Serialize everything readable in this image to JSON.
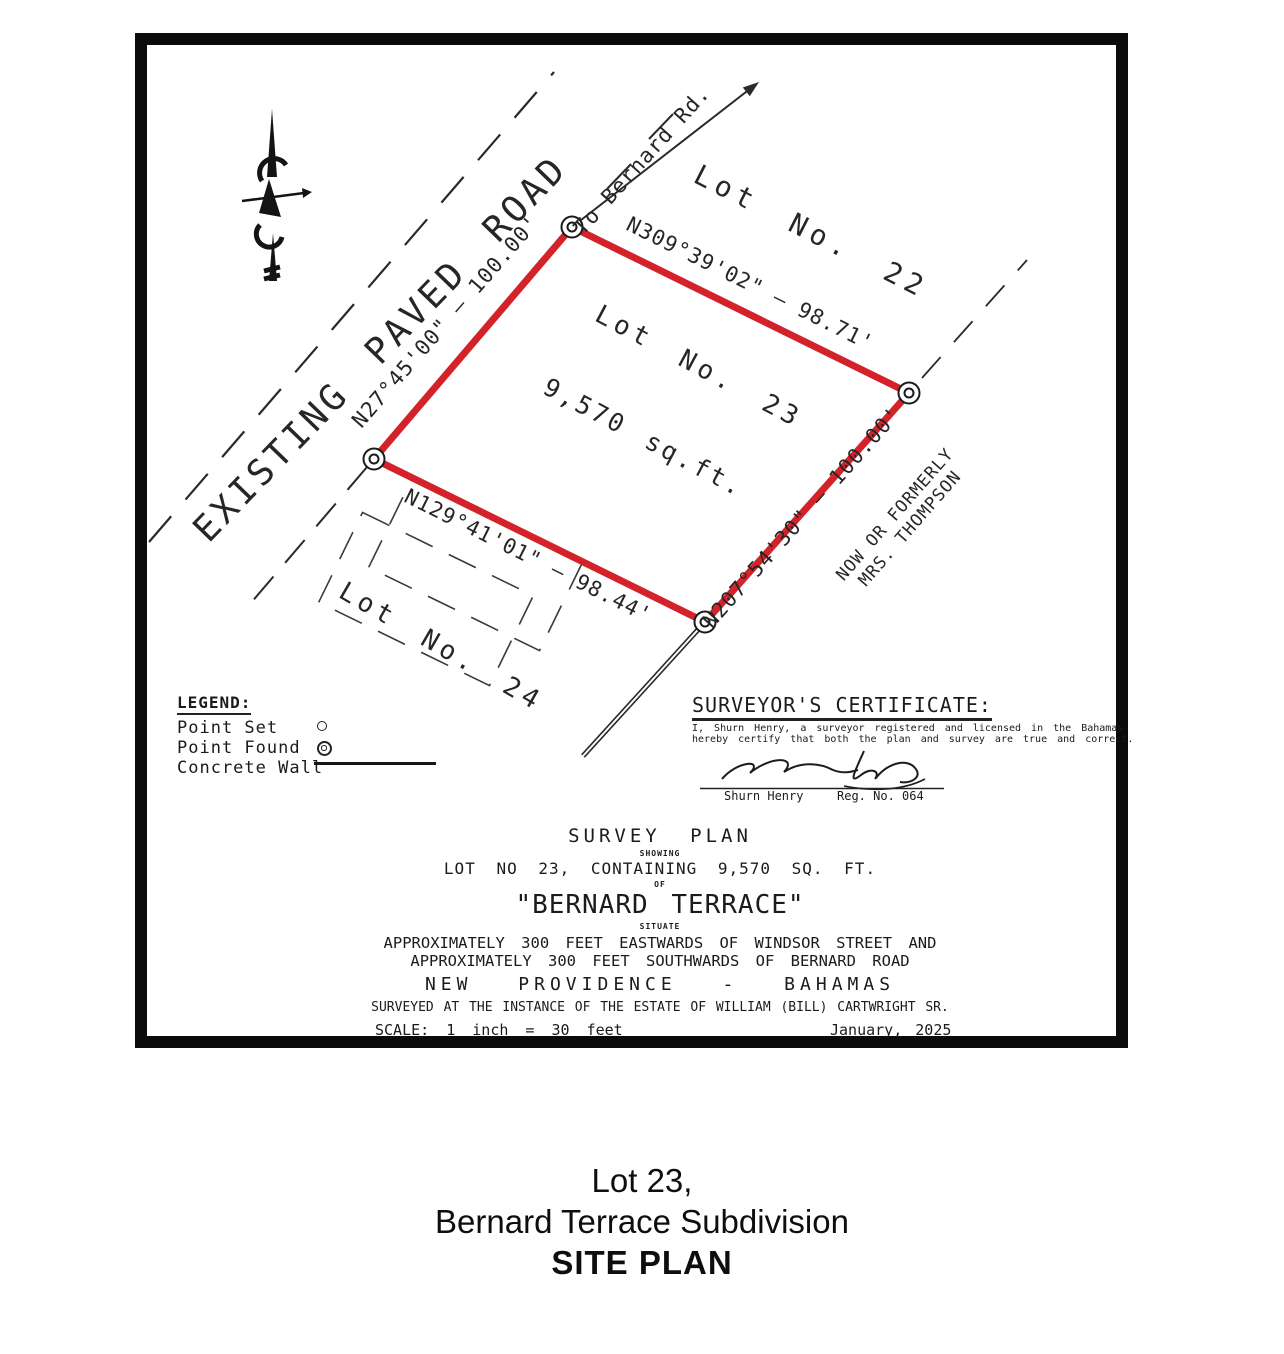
{
  "plan": {
    "road_label": "EXISTING PAVED ROAD",
    "to_road": "To Bernard Rd.",
    "lot22": "Lot No. 22",
    "lot23": "Lot No. 23",
    "lot23_area": "9,570 sq.ft.",
    "lot24": "Lot No. 24",
    "neighbor_line1": "NOW OR FORMERLY",
    "neighbor_line2": "MRS. THOMPSON",
    "bearings": {
      "left": "N27°45'00\" — 100.00'",
      "top": "N309°39'02\" — 98.71'",
      "right": "N207°54'30\" — 100.00'",
      "bottom": "N129°41'01\" — 98.44'"
    }
  },
  "legend": {
    "title": "LEGEND:",
    "point_set": "Point Set",
    "point_found": "Point Found",
    "concrete_wall": "Concrete Wall"
  },
  "certificate": {
    "title": "SURVEYOR'S CERTIFICATE:",
    "body_line1": "I, Shurn Henry, a surveyor registered and licensed in the Bahamas",
    "body_line2": "hereby certify that both the plan and survey are true and correct.",
    "signatory_name": "Shurn Henry",
    "reg_no": "Reg. No. 064"
  },
  "title_block": {
    "title": "SURVEY PLAN",
    "showing": "SHOWING",
    "lot_line": "LOT NO 23, CONTAINING 9,570 SQ. FT.",
    "of": "OF",
    "subdivision": "\"BERNARD TERRACE\"",
    "situate": "SITUATE",
    "location_line1": "APPROXIMATELY 300 FEET EASTWARDS OF WINDSOR STREET AND",
    "location_line2": "APPROXIMATELY 300 FEET SOUTHWARDS OF BERNARD ROAD",
    "island_line": "NEW PROVIDENCE - BAHAMAS",
    "instance_line": "SURVEYED AT THE INSTANCE OF THE ESTATE OF WILLIAM (BILL) CARTWRIGHT SR.",
    "scale": "SCALE: 1 inch = 30 feet",
    "date": "January, 2025"
  },
  "caption": {
    "line1": "Lot 23,",
    "line2": "Bernard Terrace Subdivision",
    "line3": "SITE PLAN"
  },
  "colors": {
    "lot_outline": "#d3222a"
  }
}
